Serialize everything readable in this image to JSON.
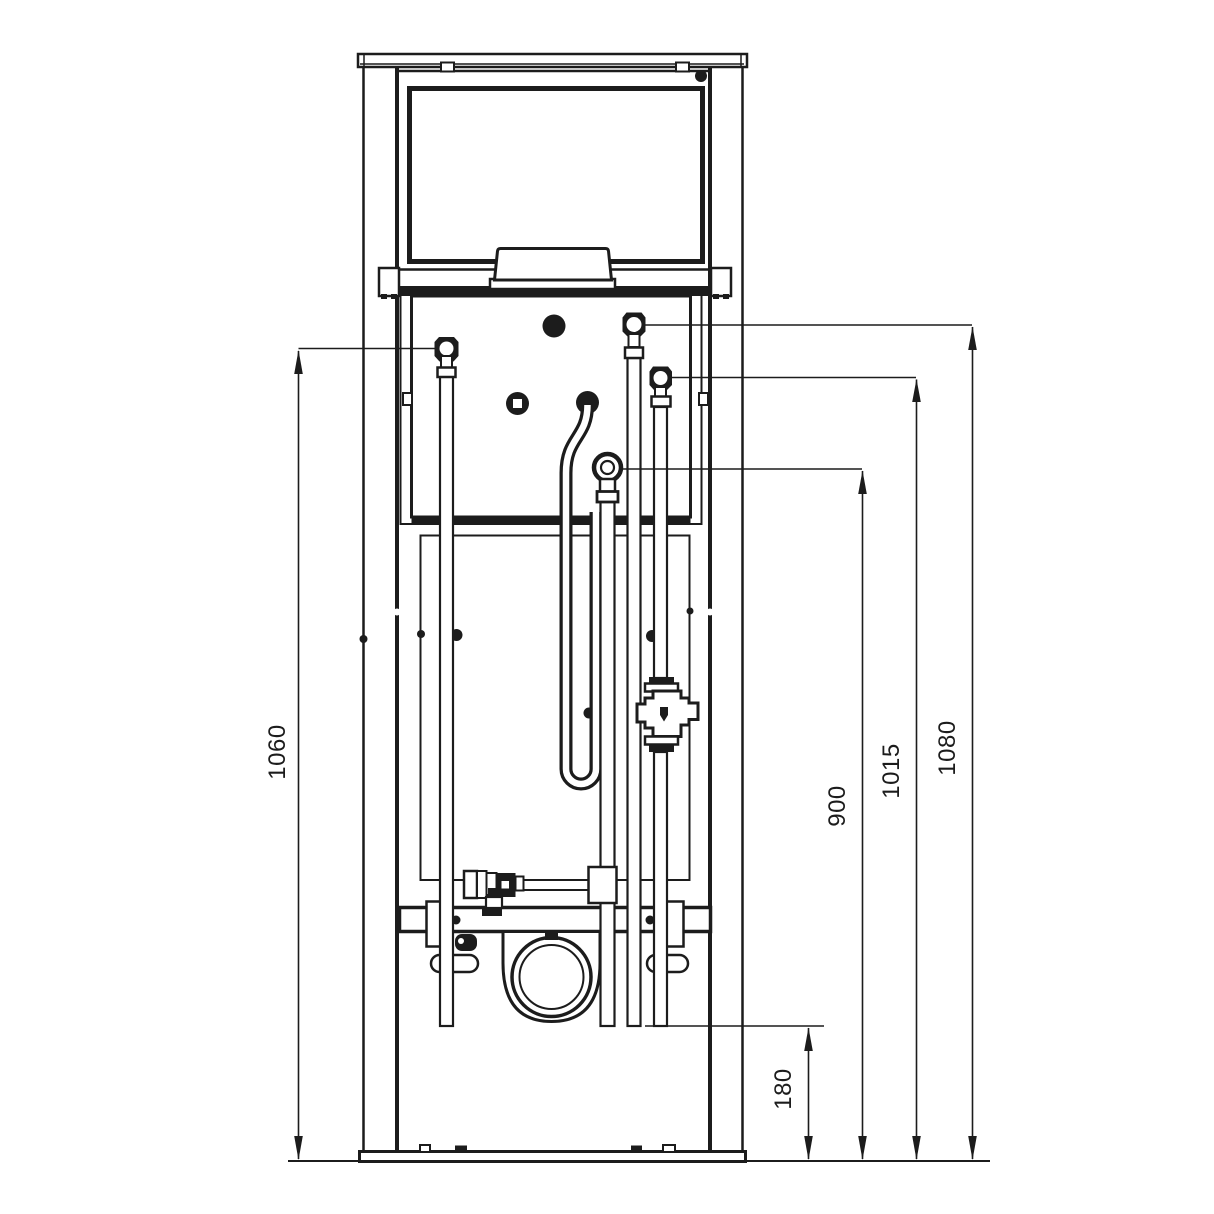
{
  "drawing": {
    "kind": "installation-frame-front-view-technical-drawing",
    "colors": {
      "line": "#1c1c1c",
      "background": "#ffffff"
    },
    "dims": {
      "left_supply_height": "1060",
      "flush_connection_height": "900",
      "mid_pipe_height": "1015",
      "outer_pipe_height": "1080",
      "pipe_end_height": "180"
    }
  }
}
